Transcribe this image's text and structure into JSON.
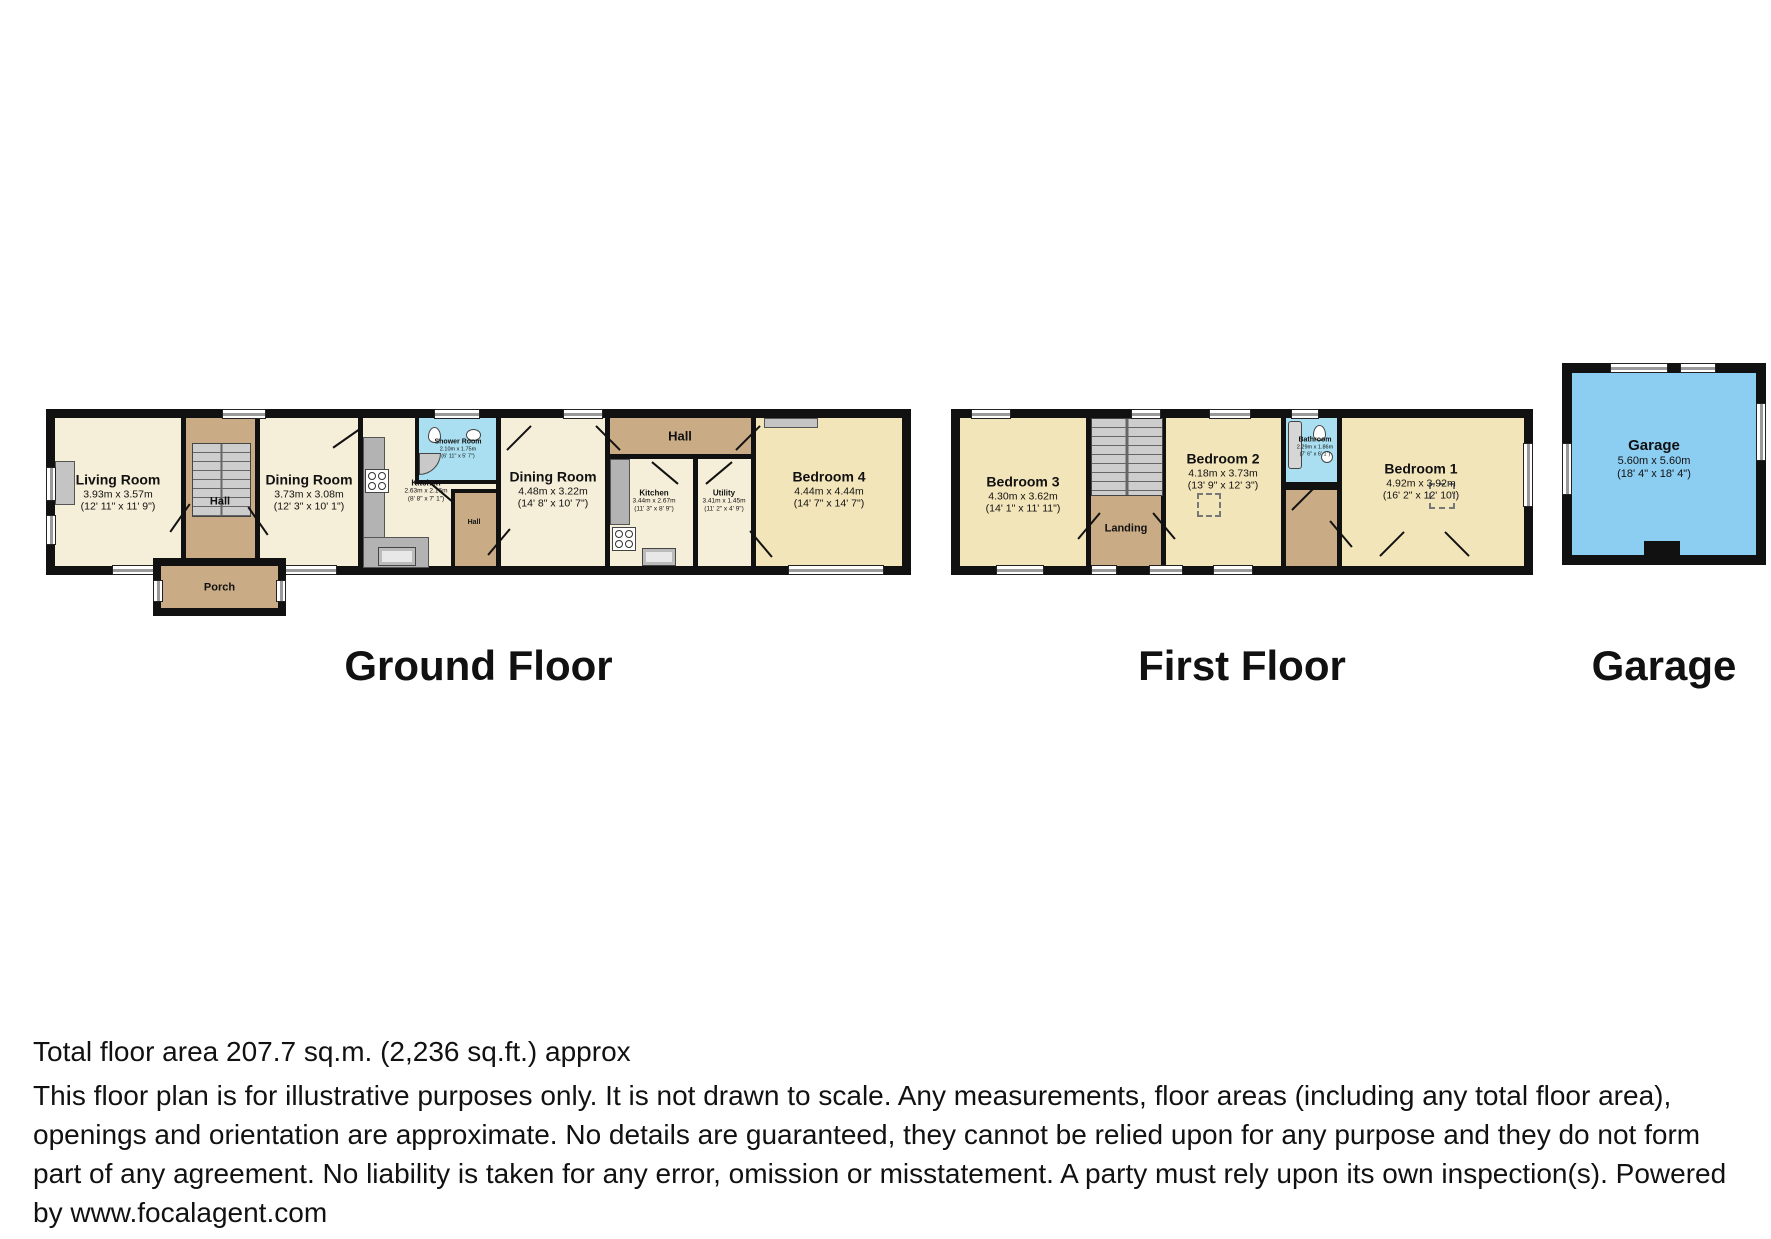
{
  "captions": {
    "ground": "Ground Floor",
    "first": "First Floor",
    "garage": "Garage"
  },
  "ground_floor": {
    "living_room": {
      "name": "Living Room",
      "dims_m": "3.93m x 3.57m",
      "dims_ft": "(12' 11\" x 11' 9\")"
    },
    "hall": {
      "name": "Hall"
    },
    "porch": {
      "name": "Porch"
    },
    "dining_room_1": {
      "name": "Dining Room",
      "dims_m": "3.73m x 3.08m",
      "dims_ft": "(12' 3\" x 10' 1\")"
    },
    "shower_room": {
      "name": "Shower Room",
      "dims_m": "2.10m x 1.75m",
      "dims_ft": "(6' 11\" x 5' 7\")"
    },
    "kitchen_1": {
      "name": "Kitchen",
      "dims_m": "2.63m x 2.16m",
      "dims_ft": "(8' 8\" x 7' 1\")"
    },
    "hall_small": {
      "name": "Hall"
    },
    "dining_room_2": {
      "name": "Dining Room",
      "dims_m": "4.48m x 3.22m",
      "dims_ft": "(14' 8\" x 10' 7\")"
    },
    "hall_top": {
      "name": "Hall"
    },
    "kitchen_2": {
      "name": "Kitchen",
      "dims_m": "3.44m x 2.67m",
      "dims_ft": "(11' 3\" x 8' 9\")"
    },
    "utility": {
      "name": "Utility",
      "dims_m": "3.41m x 1.45m",
      "dims_ft": "(11' 2\" x 4' 9\")"
    },
    "bedroom_4": {
      "name": "Bedroom 4",
      "dims_m": "4.44m x 4.44m",
      "dims_ft": "(14' 7\" x 14' 7\")"
    }
  },
  "first_floor": {
    "bedroom_3": {
      "name": "Bedroom 3",
      "dims_m": "4.30m x 3.62m",
      "dims_ft": "(14' 1\" x 11' 11\")"
    },
    "landing": {
      "name": "Landing"
    },
    "bedroom_2": {
      "name": "Bedroom 2",
      "dims_m": "4.18m x 3.73m",
      "dims_ft": "(13' 9\" x 12' 3\")"
    },
    "bathroom": {
      "name": "Bathroom",
      "dims_m": "2.29m x 1.86m",
      "dims_ft": "(7' 6\" x 6' 1\")"
    },
    "bedroom_1": {
      "name": "Bedroom 1",
      "dims_m": "4.92m x 3.92m",
      "dims_ft": "(16' 2\" x 12' 10\")"
    }
  },
  "garage": {
    "room": {
      "name": "Garage",
      "dims_m": "5.60m x 5.60m",
      "dims_ft": "(18' 4\" x 18' 4\")"
    }
  },
  "footer": {
    "total_area": "Total floor area 207.7 sq.m. (2,236 sq.ft.) approx",
    "disclaimer": "This floor plan is for illustrative purposes only. It is not drawn to scale. Any measurements, floor areas (including any total floor area), openings and orientation are approximate. No details are guaranteed, they cannot be relied upon for any purpose and they do not form part of any agreement. No liability is taken for any error, omission or misstatement. A party must rely upon its own inspection(s). Powered by www.focalagent.com"
  },
  "colors": {
    "wall_black": "#111111",
    "room_cream": "#f5eed8",
    "room_yellow": "#f3e5ba",
    "hall_brown": "#c9ab85",
    "wet_blue": "#a9dff0",
    "garage_blue": "#8ccdf2",
    "stairs_gray": "#c9c9c9",
    "counter_gray": "#b3b3b3"
  }
}
